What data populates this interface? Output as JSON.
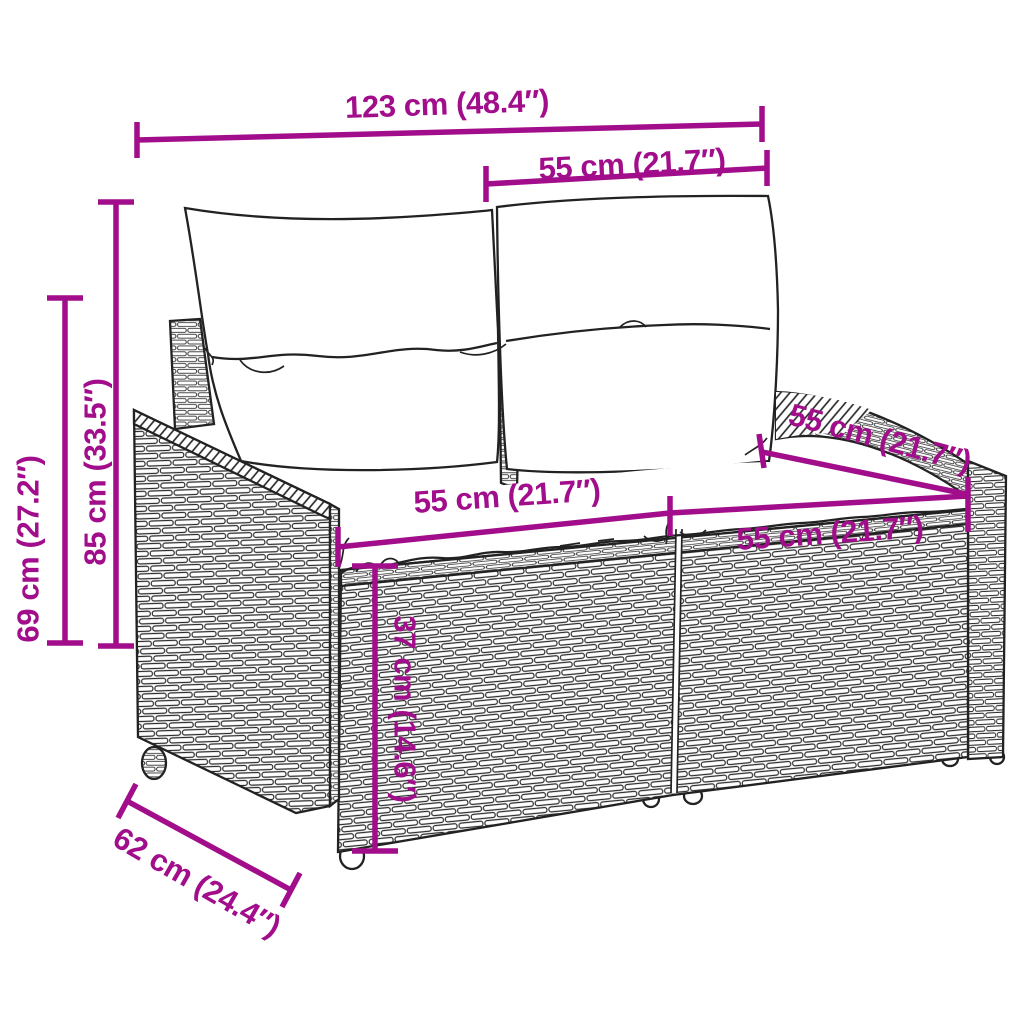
{
  "figure": {
    "type": "product-dimension-diagram",
    "subject": "poly rattan 2-seater garden sofa with back and seat cushions"
  },
  "colors": {
    "accent": "#A10D8A",
    "ink": "#222222",
    "background": "#FFFFFF"
  },
  "dimensions": {
    "overall_width": {
      "label": "123 cm (48.4″)"
    },
    "backrest_span": {
      "label": "55 cm (21.7″)"
    },
    "total_height": {
      "label": "85 cm (33.5″)"
    },
    "armrest_height": {
      "label": "69 cm (27.2″)"
    },
    "seat_width_left": {
      "label": "55 cm (21.7″)"
    },
    "seat_width_right": {
      "label": "55 cm (21.7″)"
    },
    "seat_depth": {
      "label": "55 cm (21.7″)"
    },
    "seat_height": {
      "label": "37 cm (14.6″)"
    },
    "base_depth": {
      "label": "62 cm (24.4″)"
    }
  }
}
